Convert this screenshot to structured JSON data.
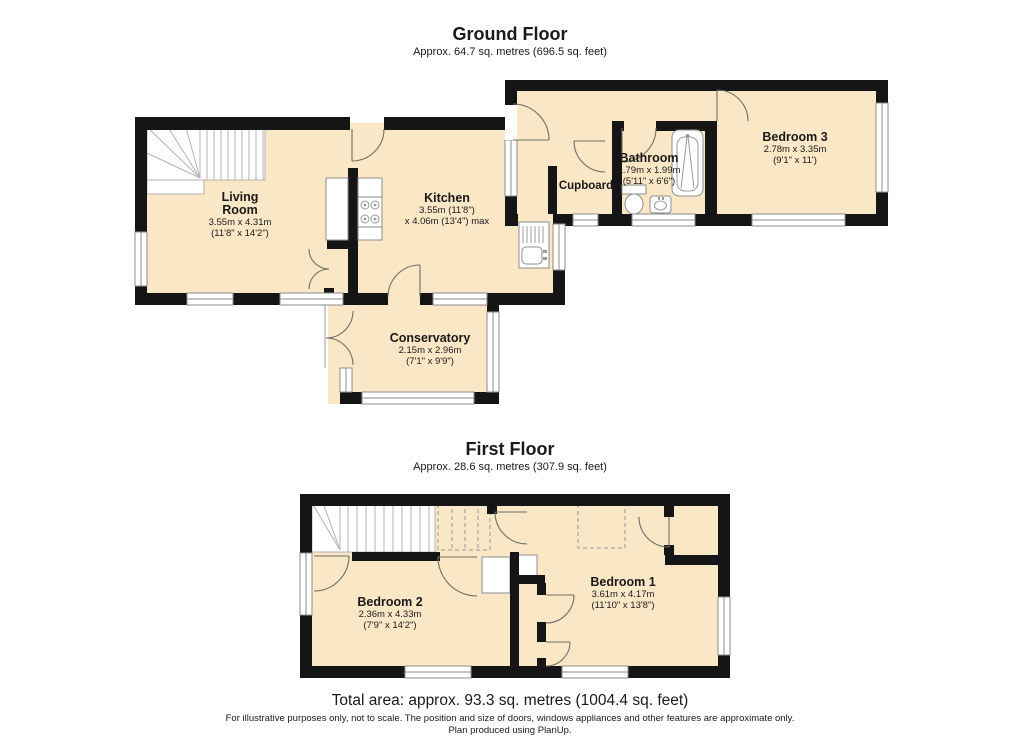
{
  "ground_floor": {
    "title": "Ground Floor",
    "subtitle": "Approx. 64.7 sq. metres (696.5 sq. feet)",
    "rooms": {
      "living_room": {
        "name1": "Living",
        "name2": "Room",
        "dims_metric": "3.55m x 4.31m",
        "dims_imperial": "(11'8\" x 14'2\")"
      },
      "kitchen": {
        "name": "Kitchen",
        "dims_line1": "3.55m (11'8\")",
        "dims_line2": "x 4.06m (13'4\") max"
      },
      "cupboard": {
        "name": "Cupboard"
      },
      "bathroom": {
        "name": "Bathroom",
        "dims_metric": "1.79m x 1.99m",
        "dims_imperial": "(5'11\" x 6'6\")"
      },
      "bedroom3": {
        "name": "Bedroom 3",
        "dims_metric": "2.78m x 3.35m",
        "dims_imperial": "(9'1\" x 11')"
      },
      "conservatory": {
        "name": "Conservatory",
        "dims_metric": "2.15m x 2.96m",
        "dims_imperial": "(7'1\" x 9'9\")"
      }
    }
  },
  "first_floor": {
    "title": "First Floor",
    "subtitle": "Approx. 28.6 sq. metres (307.9 sq. feet)",
    "rooms": {
      "bedroom2": {
        "name": "Bedroom 2",
        "dims_metric": "2.36m x 4.33m",
        "dims_imperial": "(7'9\" x 14'2\")"
      },
      "bedroom1": {
        "name": "Bedroom 1",
        "dims_metric": "3.61m x 4.17m",
        "dims_imperial": "(11'10\" x 13'8\")"
      }
    }
  },
  "summary": {
    "total_area": "Total area: approx. 93.3 sq. metres (1004.4 sq. feet)"
  },
  "footer": {
    "line1": "For illustrative purposes only, not to scale. The position and size of doors, windows appliances and other features are approximate only.",
    "line2": "Plan produced using PlanUp."
  },
  "colors": {
    "floor_fill": "#FAE7C5",
    "wall": "#151515",
    "window_stroke": "#8e8e8e",
    "door_stroke": "#6f6f66",
    "dash_stroke": "#9a9a9a",
    "text": "#1a1a1a"
  }
}
